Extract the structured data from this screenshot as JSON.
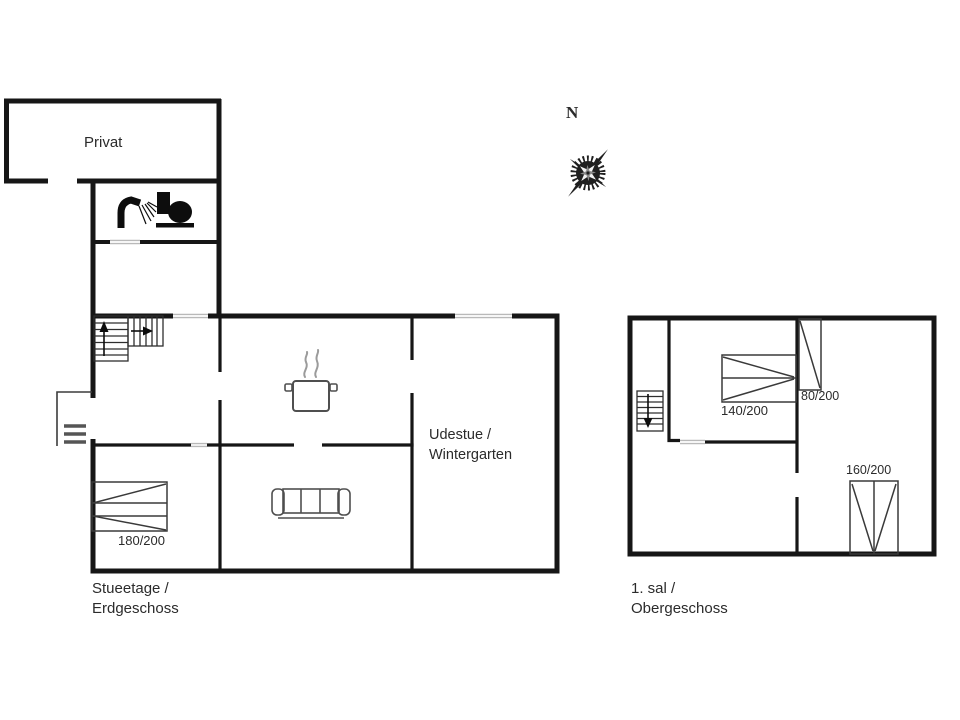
{
  "colors": {
    "wall": "#161616",
    "opening": "#b9b9b9",
    "furniture": "#4f4f4f",
    "icon": "#0d0d0d",
    "bedline": "#3a3a3a",
    "stair": "#2e2e2e",
    "steam": "#9b9b9b",
    "text": "#2b2b2b",
    "background": "#ffffff",
    "compassDark": "#1f1f1f",
    "compassLight": "#f2f2f2"
  },
  "compass": {
    "north_label": "N"
  },
  "ground_floor": {
    "caption_line1": "Stueetage /",
    "caption_line2": "Erdgeschoss",
    "room_private": "Privat",
    "room_conservatory_line1": "Udestue /",
    "room_conservatory_line2": "Wintergarten",
    "bed_double": "180/200",
    "icons": [
      "shower-icon",
      "toilet-icon",
      "stove-pot-icon",
      "sofa-icon",
      "stairs-up-icon",
      "entrance-steps-icon"
    ]
  },
  "upper_floor": {
    "caption_line1": "1. sal /",
    "caption_line2": "Obergeschoss",
    "bed_140": "140/200",
    "bed_80": "80/200",
    "bed_160": "160/200",
    "icons": [
      "stairs-down-icon"
    ]
  }
}
